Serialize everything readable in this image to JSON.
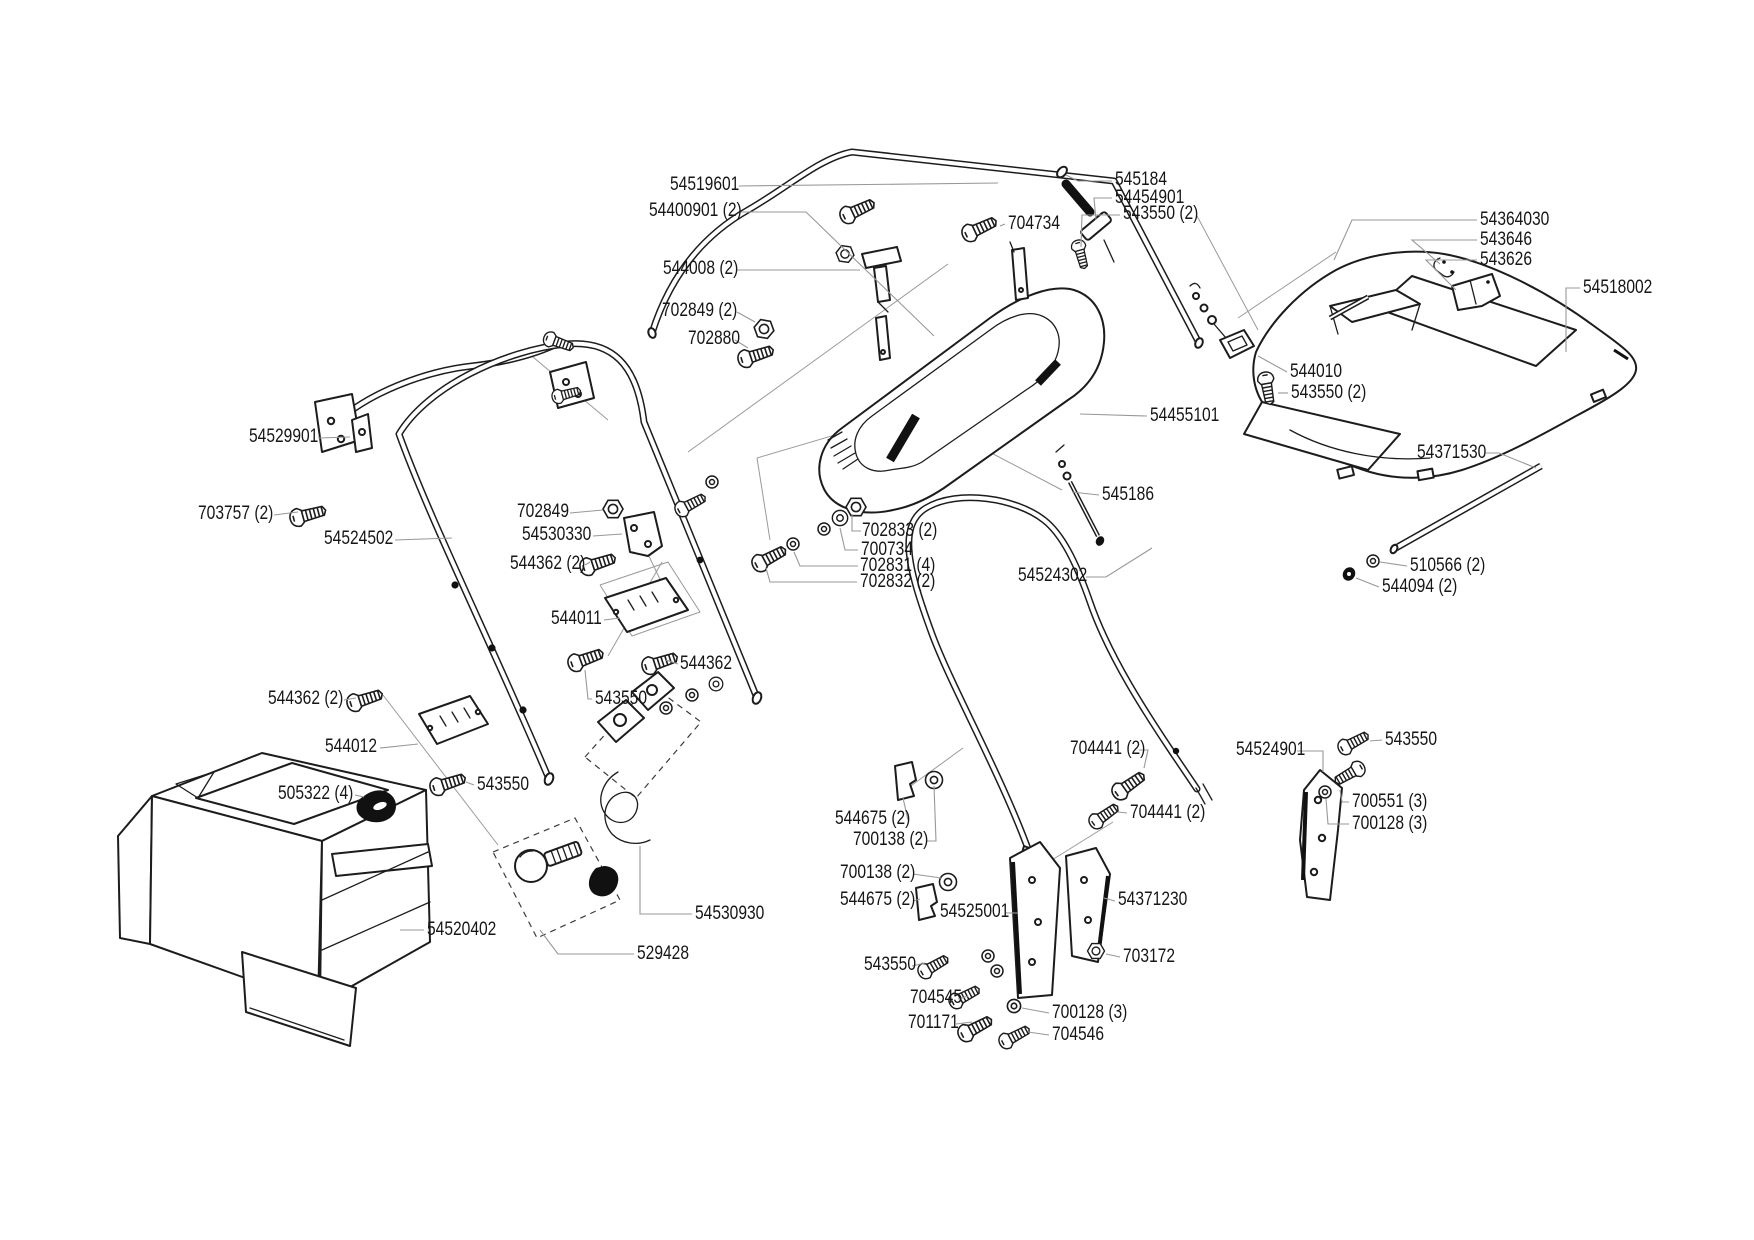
{
  "diagram": {
    "type": "exploded-parts-diagram",
    "background_color": "#ffffff",
    "line_color": "#1c1c1c",
    "leader_line_color": "#989898",
    "label_text_color": "#161616",
    "labels": [
      {
        "text": "54519601",
        "x": 670,
        "y": 175,
        "leader": [
          [
            739,
            186
          ],
          [
            998,
            183
          ]
        ]
      },
      {
        "text": "54400901 (2)",
        "x": 649,
        "y": 201,
        "leader": [
          [
            741,
            212
          ],
          [
            806,
            212
          ],
          [
            934,
            336
          ]
        ]
      },
      {
        "text": "544008 (2)",
        "x": 663,
        "y": 259,
        "leader": [
          [
            737,
            270
          ],
          [
            789,
            270
          ],
          [
            860,
            270
          ]
        ]
      },
      {
        "text": "702849 (2)",
        "x": 662,
        "y": 301,
        "leader": [
          [
            737,
            312
          ],
          [
            755,
            322
          ]
        ]
      },
      {
        "text": "702880",
        "x": 688,
        "y": 329,
        "leader": [
          [
            735,
            340
          ],
          [
            748,
            348
          ]
        ]
      },
      {
        "text": "704734",
        "x": 1008,
        "y": 214,
        "leader": [
          [
            1005,
            224
          ],
          [
            1000,
            226
          ]
        ]
      },
      {
        "text": "545184",
        "x": 1115,
        "y": 170,
        "leader": [
          [
            1112,
            181
          ],
          [
            1078,
            181
          ],
          [
            1066,
            175
          ]
        ]
      },
      {
        "text": "54454901",
        "x": 1115,
        "y": 188,
        "leader": [
          [
            1112,
            198
          ],
          [
            1094,
            198
          ],
          [
            1096,
            220
          ]
        ]
      },
      {
        "text": "543550 (2)",
        "x": 1123,
        "y": 204,
        "leader": [
          [
            1120,
            215
          ],
          [
            1082,
            215
          ],
          [
            1081,
            247
          ]
        ]
      },
      {
        "text": "54364030",
        "x": 1480,
        "y": 210,
        "leader": [
          [
            1477,
            220
          ],
          [
            1352,
            220
          ],
          [
            1334,
            260
          ]
        ]
      },
      {
        "text": "543646",
        "x": 1480,
        "y": 230,
        "leader": [
          [
            1477,
            240
          ],
          [
            1412,
            240
          ],
          [
            1440,
            264
          ]
        ]
      },
      {
        "text": "543626",
        "x": 1480,
        "y": 250,
        "leader": [
          [
            1477,
            260
          ],
          [
            1426,
            260
          ],
          [
            1456,
            290
          ]
        ]
      },
      {
        "text": "54518002",
        "x": 1583,
        "y": 278,
        "leader": [
          [
            1580,
            288
          ],
          [
            1566,
            288
          ],
          [
            1566,
            352
          ]
        ]
      },
      {
        "text": "544010",
        "x": 1290,
        "y": 362,
        "leader": [
          [
            1287,
            372
          ],
          [
            1258,
            356
          ]
        ]
      },
      {
        "text": "543550 (2)",
        "x": 1291,
        "y": 383,
        "leader": [
          [
            1288,
            393
          ],
          [
            1278,
            393
          ]
        ]
      },
      {
        "text": "54455101",
        "x": 1150,
        "y": 406,
        "leader": [
          [
            1147,
            416
          ],
          [
            1080,
            414
          ]
        ]
      },
      {
        "text": "545186",
        "x": 1102,
        "y": 485,
        "leader": [
          [
            1099,
            495
          ],
          [
            1072,
            492
          ]
        ]
      },
      {
        "text": "54371530",
        "x": 1417,
        "y": 443,
        "leader": [
          [
            1486,
            453
          ],
          [
            1499,
            453
          ],
          [
            1536,
            468
          ]
        ]
      },
      {
        "text": "510566 (2)",
        "x": 1410,
        "y": 556,
        "leader": [
          [
            1407,
            566
          ],
          [
            1380,
            562
          ]
        ]
      },
      {
        "text": "544094 (2)",
        "x": 1382,
        "y": 577,
        "leader": [
          [
            1379,
            587
          ],
          [
            1356,
            578
          ]
        ]
      },
      {
        "text": "54529901",
        "x": 249,
        "y": 427,
        "leader": [
          [
            318,
            438
          ],
          [
            350,
            437
          ]
        ]
      },
      {
        "text": "703757 (2)",
        "x": 198,
        "y": 504,
        "leader": [
          [
            274,
            515
          ],
          [
            298,
            512
          ]
        ]
      },
      {
        "text": "702849",
        "x": 517,
        "y": 502,
        "leader": [
          [
            570,
            513
          ],
          [
            603,
            510
          ]
        ]
      },
      {
        "text": "54530330",
        "x": 522,
        "y": 525,
        "leader": [
          [
            593,
            536
          ],
          [
            622,
            534
          ]
        ]
      },
      {
        "text": "544362 (2)",
        "x": 510,
        "y": 554,
        "leader": [
          [
            585,
            565
          ],
          [
            590,
            562
          ]
        ]
      },
      {
        "text": "54524502",
        "x": 324,
        "y": 529,
        "leader": [
          [
            395,
            540
          ],
          [
            452,
            538
          ]
        ]
      },
      {
        "text": "544011",
        "x": 551,
        "y": 609,
        "leader": [
          [
            604,
            620
          ],
          [
            620,
            618
          ]
        ]
      },
      {
        "text": "544362",
        "x": 680,
        "y": 654,
        "leader": [
          [
            678,
            664
          ],
          [
            666,
            660
          ]
        ]
      },
      {
        "text": "543550",
        "x": 595,
        "y": 689,
        "leader": [
          [
            592,
            699
          ],
          [
            588,
            699
          ],
          [
            585,
            670
          ]
        ]
      },
      {
        "text": "544362 (2)",
        "x": 268,
        "y": 689,
        "leader": [
          [
            344,
            700
          ],
          [
            356,
            698
          ]
        ]
      },
      {
        "text": "544012",
        "x": 325,
        "y": 737,
        "leader": [
          [
            380,
            748
          ],
          [
            418,
            744
          ]
        ]
      },
      {
        "text": "505322 (4)",
        "x": 278,
        "y": 784,
        "leader": [
          [
            355,
            795
          ],
          [
            364,
            797
          ]
        ]
      },
      {
        "text": "543550",
        "x": 477,
        "y": 775,
        "leader": [
          [
            474,
            785
          ],
          [
            466,
            782
          ]
        ]
      },
      {
        "text": "54530930",
        "x": 695,
        "y": 904,
        "leader": [
          [
            692,
            914
          ],
          [
            640,
            914
          ],
          [
            640,
            846
          ]
        ]
      },
      {
        "text": "529428",
        "x": 637,
        "y": 944,
        "leader": [
          [
            634,
            954
          ],
          [
            558,
            954
          ],
          [
            540,
            930
          ]
        ]
      },
      {
        "text": "54520402",
        "x": 427,
        "y": 920,
        "leader": [
          [
            424,
            930
          ],
          [
            400,
            930
          ]
        ]
      },
      {
        "text": "54524302",
        "x": 1018,
        "y": 566,
        "leader": [
          [
            1086,
            577
          ],
          [
            1106,
            577
          ],
          [
            1152,
            548
          ]
        ]
      },
      {
        "text": "702833 (2)",
        "x": 862,
        "y": 521,
        "leader": [
          [
            861,
            531
          ],
          [
            852,
            531
          ],
          [
            852,
            514
          ]
        ]
      },
      {
        "text": "700734",
        "x": 861,
        "y": 540,
        "leader": [
          [
            858,
            550
          ],
          [
            845,
            550
          ],
          [
            840,
            528
          ]
        ]
      },
      {
        "text": "702831 (4)",
        "x": 860,
        "y": 556,
        "leader": [
          [
            858,
            566
          ],
          [
            800,
            566
          ],
          [
            794,
            552
          ]
        ]
      },
      {
        "text": "702832 (2)",
        "x": 860,
        "y": 572,
        "leader": [
          [
            857,
            582
          ],
          [
            770,
            582
          ],
          [
            766,
            568
          ]
        ]
      },
      {
        "text": "704441 (2)",
        "x": 1070,
        "y": 739,
        "leader": [
          [
            1139,
            750
          ],
          [
            1148,
            750
          ],
          [
            1144,
            768
          ]
        ]
      },
      {
        "text": "54524901",
        "x": 1236,
        "y": 740,
        "leader": [
          [
            1297,
            751
          ],
          [
            1323,
            751
          ],
          [
            1323,
            772
          ]
        ]
      },
      {
        "text": "543550",
        "x": 1385,
        "y": 730,
        "leader": [
          [
            1382,
            740
          ],
          [
            1370,
            741
          ]
        ]
      },
      {
        "text": "700551 (3)",
        "x": 1352,
        "y": 792,
        "leader": [
          [
            1349,
            802
          ],
          [
            1342,
            802
          ],
          [
            1340,
            790
          ]
        ]
      },
      {
        "text": "700128 (3)",
        "x": 1352,
        "y": 814,
        "leader": [
          [
            1349,
            824
          ],
          [
            1328,
            824
          ],
          [
            1326,
            799
          ]
        ]
      },
      {
        "text": "704441 (2)",
        "x": 1130,
        "y": 803,
        "leader": [
          [
            1127,
            813
          ],
          [
            1118,
            812
          ]
        ]
      },
      {
        "text": "544675 (2)",
        "x": 835,
        "y": 809,
        "leader": [
          [
            908,
            820
          ],
          [
            903,
            798
          ]
        ]
      },
      {
        "text": "700138 (2)",
        "x": 853,
        "y": 830,
        "leader": [
          [
            926,
            841
          ],
          [
            936,
            841
          ],
          [
            934,
            786
          ]
        ]
      },
      {
        "text": "700138 (2)",
        "x": 840,
        "y": 863,
        "leader": [
          [
            913,
            874
          ],
          [
            941,
            878
          ]
        ]
      },
      {
        "text": "544675 (2)",
        "x": 840,
        "y": 890,
        "leader": [
          [
            913,
            901
          ],
          [
            920,
            899
          ]
        ]
      },
      {
        "text": "54525001",
        "x": 940,
        "y": 902,
        "leader": [
          [
            1006,
            913
          ],
          [
            1018,
            913
          ]
        ]
      },
      {
        "text": "54371230",
        "x": 1118,
        "y": 890,
        "leader": [
          [
            1115,
            901
          ],
          [
            1104,
            898
          ]
        ]
      },
      {
        "text": "703172",
        "x": 1123,
        "y": 947,
        "leader": [
          [
            1120,
            957
          ],
          [
            1106,
            954
          ]
        ]
      },
      {
        "text": "543550",
        "x": 864,
        "y": 955,
        "leader": [
          [
            912,
            966
          ],
          [
            925,
            963
          ]
        ]
      },
      {
        "text": "704545",
        "x": 910,
        "y": 988,
        "leader": [
          [
            958,
            999
          ],
          [
            968,
            996
          ]
        ]
      },
      {
        "text": "701171",
        "x": 908,
        "y": 1013,
        "leader": [
          [
            956,
            1024
          ],
          [
            972,
            1022
          ]
        ]
      },
      {
        "text": "700128 (3)",
        "x": 1052,
        "y": 1003,
        "leader": [
          [
            1049,
            1013
          ],
          [
            1022,
            1008
          ]
        ]
      },
      {
        "text": "704546",
        "x": 1052,
        "y": 1025,
        "leader": [
          [
            1049,
            1035
          ],
          [
            1028,
            1032
          ]
        ]
      }
    ]
  }
}
